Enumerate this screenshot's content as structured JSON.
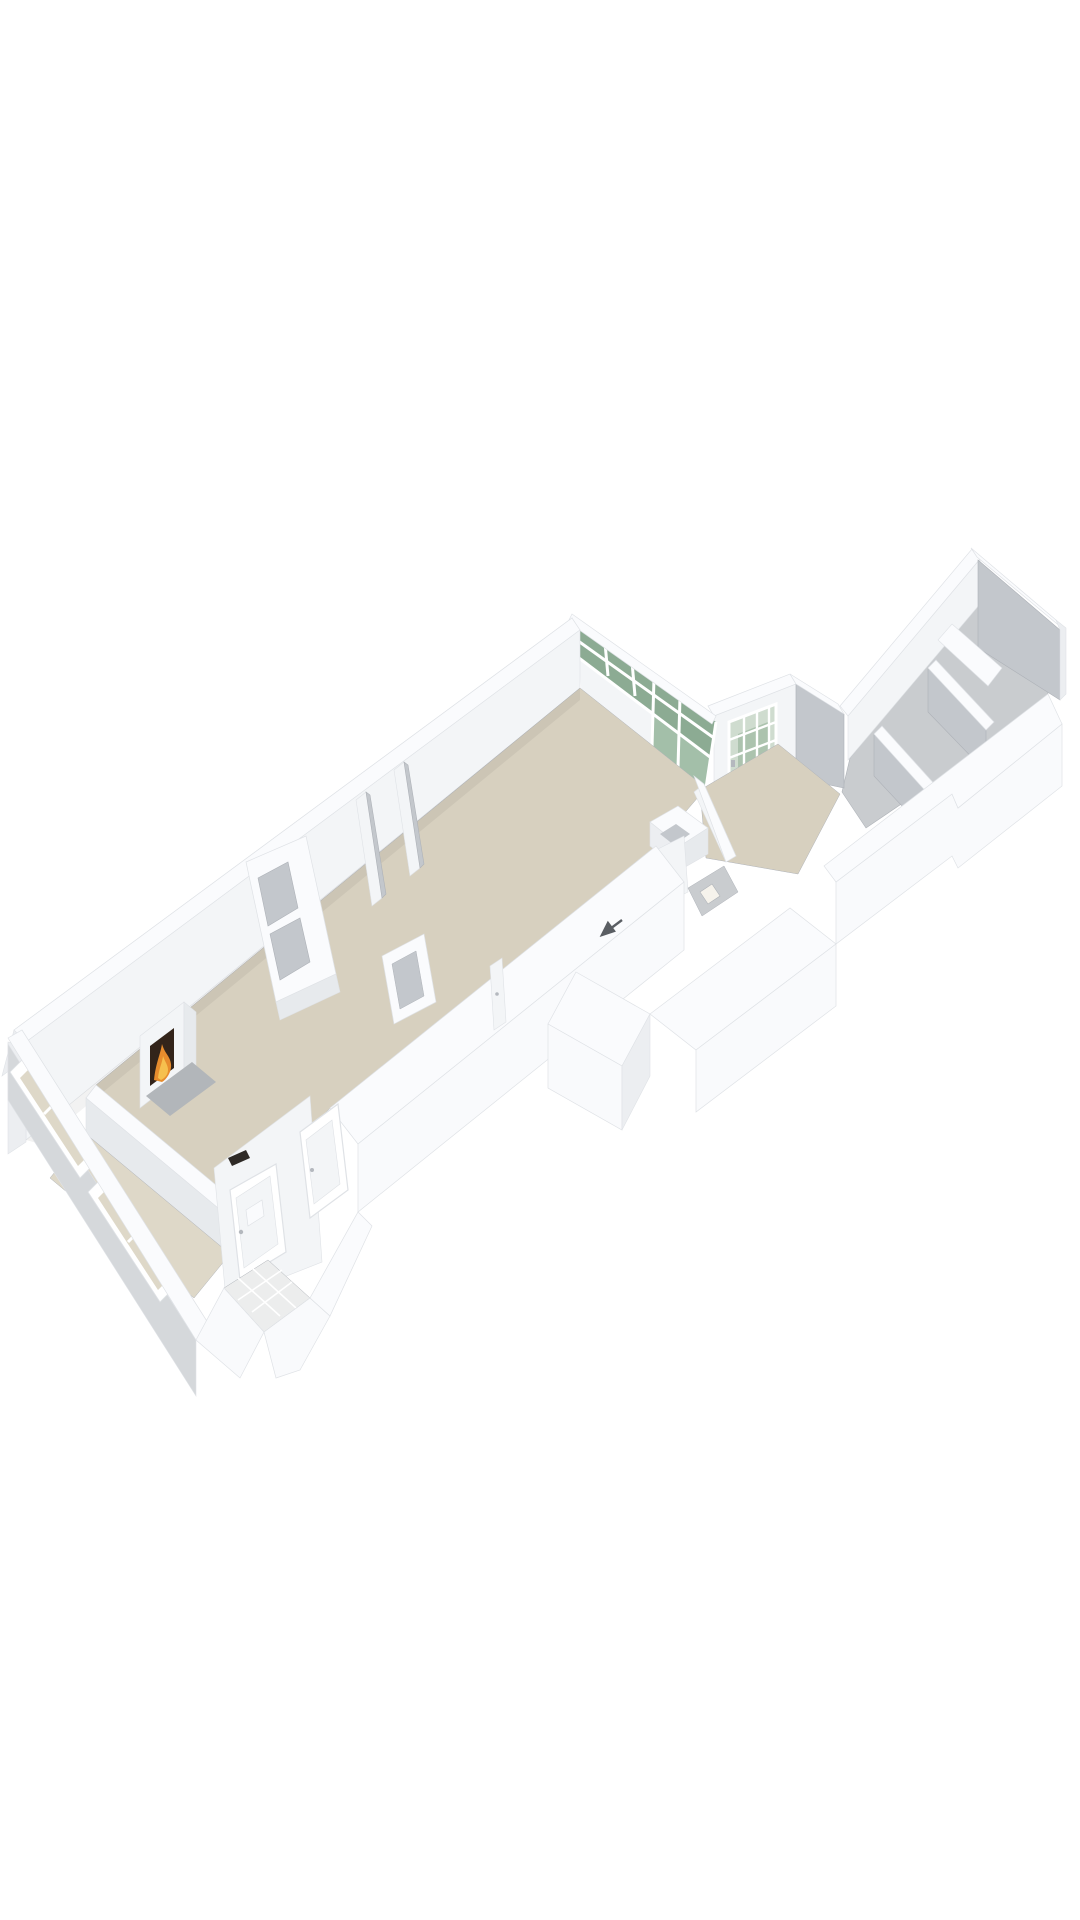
{
  "image_type": "3d-floorplan-isometric-render",
  "page": {
    "background": "#ffffff",
    "width": 1080,
    "height": 1920
  },
  "palette": {
    "bg": "#ffffff",
    "wall-top": "#fafbfd",
    "face-light": "#f3f5f7",
    "face-mid": "#e7eaed",
    "face-shade": "#c3c7cc",
    "face-dark": "#b4b8be",
    "outer-face": "#eceef1",
    "outer-bright": "#f9fafc",
    "outer-grey": "#d5d8db",
    "edge": "#dfe2e6",
    "edge-dark": "#aeb2b8",
    "floor-beige": "#d7d0bf",
    "floor-beige-light": "#ded8c8",
    "floor-grey": "#c9cccf",
    "tile": "#eceded",
    "tile-grout": "#ffffff",
    "glass-green": "#7fa287",
    "glass-green-light": "#a3bfa9",
    "door-pane": "#cfdccf",
    "door-pane-green": "#8fae94",
    "fire-dark": "#33241a",
    "flame-orange": "#e78c2d",
    "flame-yellow": "#f6c04e",
    "hearth": "#b2b6ba",
    "marker-dark": "#2e2a26",
    "arrow": "#5a5e63",
    "shadow": "#000000"
  },
  "scene": {
    "description": "Axonometric 3D render of an elongated single-floor apartment with attached shed strip",
    "rooms": [
      {
        "id": "living-room",
        "floor_color_key": "floor-beige"
      },
      {
        "id": "dining-room",
        "floor_color_key": "floor-beige"
      },
      {
        "id": "conservatory-bay",
        "floor_color_key": "floor-beige-light"
      },
      {
        "id": "entrance-hall",
        "floor_color_key": "floor-beige"
      },
      {
        "id": "wc-niche",
        "floor_color_key": "floor-grey"
      },
      {
        "id": "shed-compartments",
        "floor_color_key": "floor-grey"
      },
      {
        "id": "porch",
        "floor_color_key": "tile"
      }
    ],
    "features": [
      {
        "id": "fireplace",
        "accent_keys": [
          "fire-dark",
          "flame-orange",
          "flame-yellow"
        ]
      },
      {
        "id": "glazed-clerestory-wall",
        "accent_keys": [
          "glass-green",
          "glass-green-light"
        ]
      },
      {
        "id": "green-glazed-door",
        "accent_keys": [
          "door-pane",
          "door-pane-green"
        ]
      },
      {
        "id": "bay-windows",
        "accent_keys": [
          "floor-beige-light"
        ]
      },
      {
        "id": "front-door",
        "accent_keys": [
          "wall-top"
        ]
      },
      {
        "id": "hall-counter",
        "accent_keys": [
          "wall-top",
          "face-shade"
        ]
      },
      {
        "id": "entrance-arrow",
        "accent_keys": [
          "arrow"
        ]
      },
      {
        "id": "door-marker",
        "accent_keys": [
          "marker-dark"
        ]
      }
    ]
  }
}
